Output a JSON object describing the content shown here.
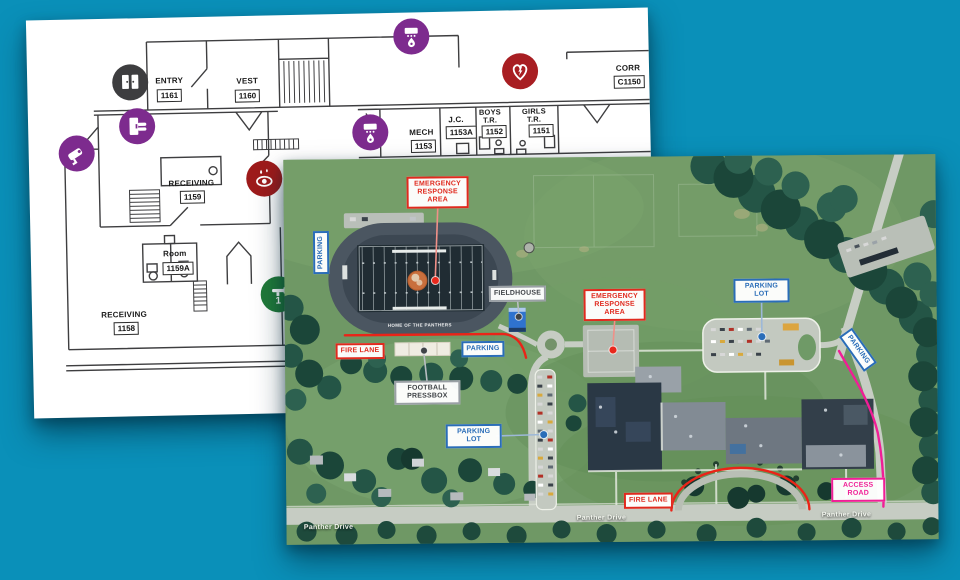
{
  "background_color": "#0a90b9",
  "floor_plan": {
    "rooms": {
      "entry": {
        "label": "ENTRY",
        "number": "1161"
      },
      "vest": {
        "label": "VEST",
        "number": "1160"
      },
      "corr": {
        "label": "CORR",
        "number": "C1150"
      },
      "mech": {
        "label": "MECH",
        "number": "1153"
      },
      "jc": {
        "label": "J.C.",
        "number": "1153A"
      },
      "boys": {
        "label": "BOYS",
        "label2": "T.R.",
        "number": "1152"
      },
      "girls": {
        "label": "GIRLS",
        "label2": "T.R.",
        "number": "1151"
      },
      "receiving_1159": {
        "label": "RECEIVING",
        "number": "1159"
      },
      "room_1159a": {
        "label": "Room",
        "number": "1159A"
      },
      "receiving_1158": {
        "label": "RECEIVING",
        "number": "1158"
      }
    },
    "icons": {
      "entry_doors": "double-doors",
      "secure_door": "access-control-door",
      "camera": "security-camera",
      "fire_alarm_1": "fire-alarm",
      "fire_alarm_2": "fire-alarm",
      "aed": "aed-defibrillator",
      "eyewash": "eyewash-station",
      "shutoff": "utility-shutoff-1"
    },
    "colors": {
      "purple": "#7d2b8e",
      "gray": "#3d3d3f",
      "red": "#a81e22",
      "dark_red": "#9e1b1b",
      "green": "#207a39"
    }
  },
  "map": {
    "labels": {
      "era": "EMERGENCY RESPONSE AREA",
      "parking": "PARKING",
      "parking_lot": "PARKING LOT",
      "fieldhouse": "FIELDHOUSE",
      "fire_lane": "FIRE LANE",
      "pressbox": "FOOTBALL PRESSBOX",
      "access_road": "ACCESS ROAD"
    },
    "street": "Panther Drive",
    "field_text": "HOME OF THE PANTHERS",
    "colors": {
      "label_red": "#e02a1e",
      "label_blue": "#2a6db8",
      "label_magenta": "#f01e96",
      "label_gray": "#3f4347",
      "fire_lane_line": "#ea2418",
      "access_road_line": "#f01e96"
    }
  }
}
